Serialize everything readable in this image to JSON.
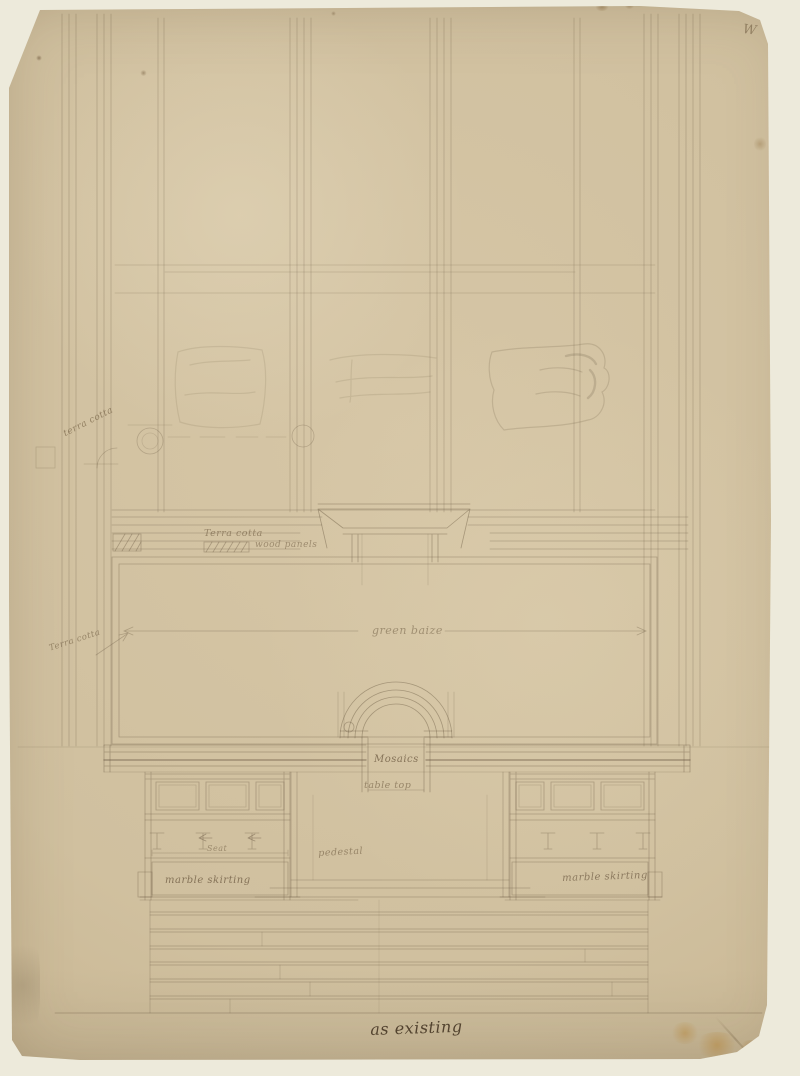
{
  "annotations": {
    "terra_cotta_upper": "terra cotta",
    "terra_cotta_band": "Terra cotta",
    "wood_panels": "wood panels",
    "green_baize": "green baize",
    "terra_cotta_left": "Terra cotta",
    "mosaics": "Mosaics",
    "table_top": "table top",
    "seat": "Seat",
    "pedestal": "pedestal",
    "marble_skirting_left": "marble skirting",
    "marble_skirting_right": "marble skirting",
    "as_existing": "as existing",
    "corner_mark": "W"
  },
  "colors": {
    "backdrop": "#edeadb",
    "paper": "#d2c2a1",
    "paper_edge": "#b9a480",
    "pencil": "#6b5a43",
    "ink": "#3e2f1d",
    "stain": "#b98a3f"
  }
}
